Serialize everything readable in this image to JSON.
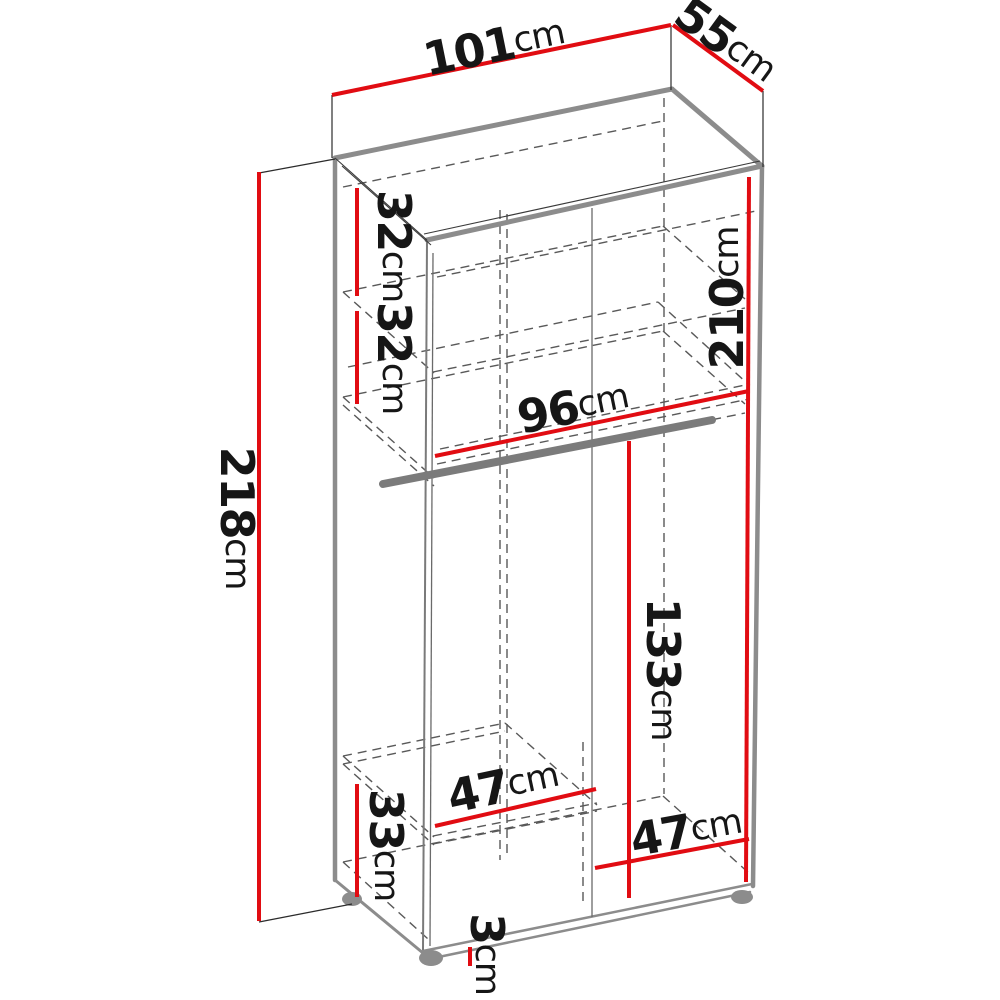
{
  "diagram": {
    "type": "furniture-dimension-diagram",
    "subject": "wardrobe interior dimensions",
    "unit": "cm",
    "accent_color": "#e10c12",
    "line_color": "#8c8c8c",
    "dims": {
      "width_101": {
        "num": "101",
        "unit": "cm",
        "value": 101,
        "orientation": "top-width"
      },
      "depth_55": {
        "num": "55",
        "unit": "cm",
        "value": 55,
        "orientation": "top-depth"
      },
      "height_218": {
        "num": "218",
        "unit": "cm",
        "value": 218,
        "orientation": "total-height"
      },
      "gap_32a": {
        "num": "32",
        "unit": "cm",
        "value": 32,
        "orientation": "shelf-gap-upper"
      },
      "gap_32b": {
        "num": "32",
        "unit": "cm",
        "value": 32,
        "orientation": "shelf-gap-lower"
      },
      "interior_210": {
        "num": "210",
        "unit": "cm",
        "value": 210,
        "orientation": "interior-height"
      },
      "width_96": {
        "num": "96",
        "unit": "cm",
        "value": 96,
        "orientation": "interior-width"
      },
      "hanging_133": {
        "num": "133",
        "unit": "cm",
        "value": 133,
        "orientation": "hanging-space-height"
      },
      "bottom_33": {
        "num": "33",
        "unit": "cm",
        "value": 33,
        "orientation": "bottom-section-height"
      },
      "shelf_47l": {
        "num": "47",
        "unit": "cm",
        "value": 47,
        "orientation": "left-compartment-width"
      },
      "shelf_47r": {
        "num": "47",
        "unit": "cm",
        "value": 47,
        "orientation": "right-compartment-width"
      },
      "plinth_3": {
        "num": "3",
        "unit": "cm",
        "value": 3,
        "orientation": "plinth-height"
      }
    }
  }
}
